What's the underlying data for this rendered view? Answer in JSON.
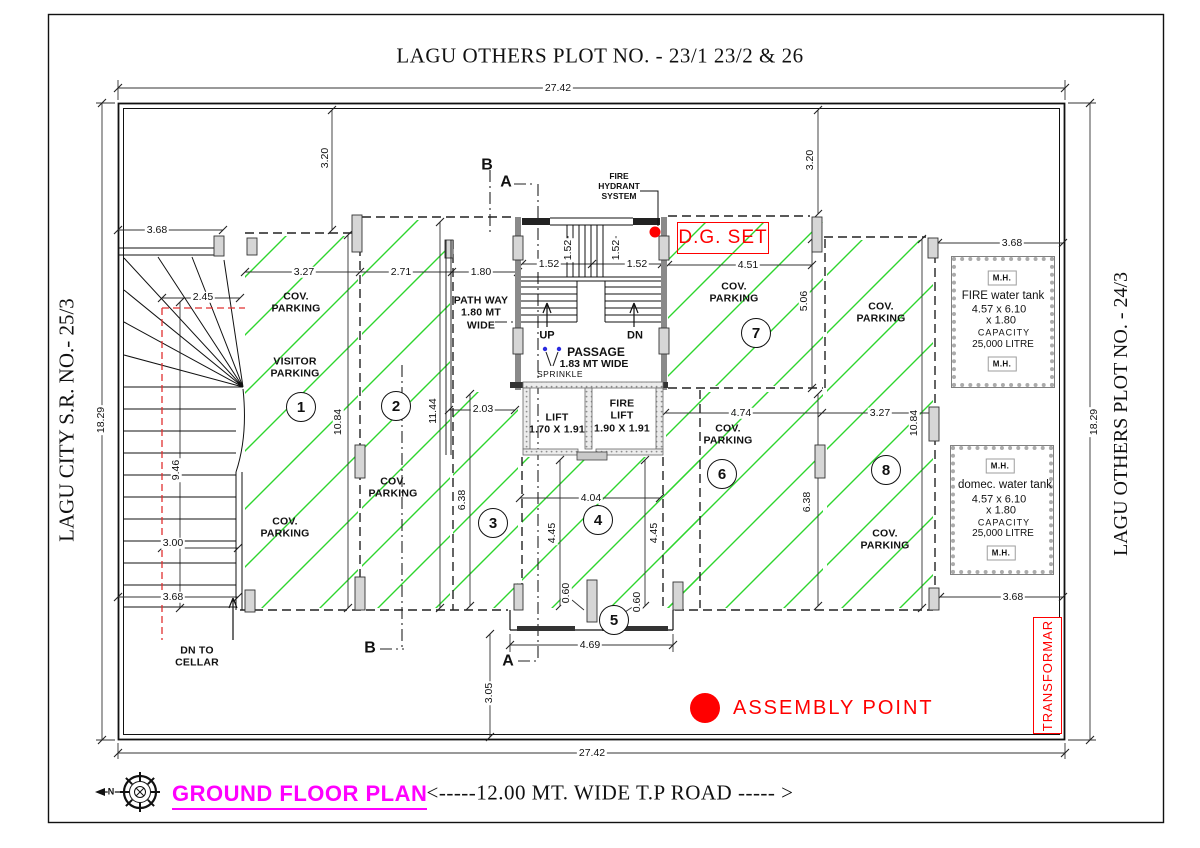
{
  "title": "LAGU OTHERS PLOT NO. - 23/1 23/2  &  26",
  "side_labels": {
    "left": "LAGU CITY S.R. NO.- 25/3",
    "right": "LAGU OTHERS PLOT NO. - 24/3"
  },
  "footer": {
    "plan_name": "GROUND FLOOR PLAN",
    "road_label": "<-----12.00 MT. WIDE T.P ROAD   ----- >",
    "north_letter": "N"
  },
  "annotations": {
    "dg_set": "D.G. SET",
    "assembly_point": "ASSEMBLY POINT",
    "transformer": "TRANSFORMAR",
    "fire_hydrant": "FIRE\nHYDRANT\nSYSTEM",
    "dn_to_cellar": "DN TO\nCELLAR",
    "visitor_parking": "VISITOR\nPARKING",
    "cov_parking": "COV.\nPARKING",
    "path_way": "PATH WAY\n1.80 MT\nWIDE",
    "passage": "PASSAGE",
    "passage_width": "1.83 MT WIDE",
    "sprinkle": "SPRINKLE",
    "up": "UP",
    "dn": "DN",
    "lift": "LIFT\n1.70 X 1.91",
    "fire_lift": "FIRE\nLIFT\n1.90 X 1.91",
    "mh": "M.H.",
    "section_a": "A",
    "section_b": "B"
  },
  "tanks": {
    "fire": {
      "name": "FIRE water tank",
      "size_line1": "4.57 x 6.10",
      "size_line2": "x 1.80",
      "capacity_label": "CAPACITY",
      "capacity_value": "25,000 LITRE"
    },
    "domestic": {
      "name": "domec. water tank",
      "size_line1": "4.57 x 6.10",
      "size_line2": "x 1.80",
      "capacity_label": "CAPACITY",
      "capacity_value": "25,000 LITRE"
    }
  },
  "parking_numbers": [
    "1",
    "2",
    "3",
    "4",
    "5",
    "6",
    "7",
    "8"
  ],
  "dims": {
    "d2742": "27.42",
    "d1829": "18.29",
    "d368": "3.68",
    "d320": "3.20",
    "d327": "3.27",
    "d271": "2.71",
    "d180": "1.80",
    "d152": "1.52",
    "d451": "4.51",
    "d506": "5.06",
    "d245": "2.45",
    "d946": "9.46",
    "d300": "3.00",
    "d1084": "10.84",
    "d1144": "11.44",
    "d203": "2.03",
    "d638": "6.38",
    "d404": "4.04",
    "d445": "4.45",
    "d474": "4.74",
    "d060": "0.60",
    "d469": "4.69",
    "d305": "3.05"
  },
  "colors": {
    "hatch_green": "#2ed52e",
    "alert_red": "#ff0000",
    "plan_magenta": "#ff00ff"
  }
}
